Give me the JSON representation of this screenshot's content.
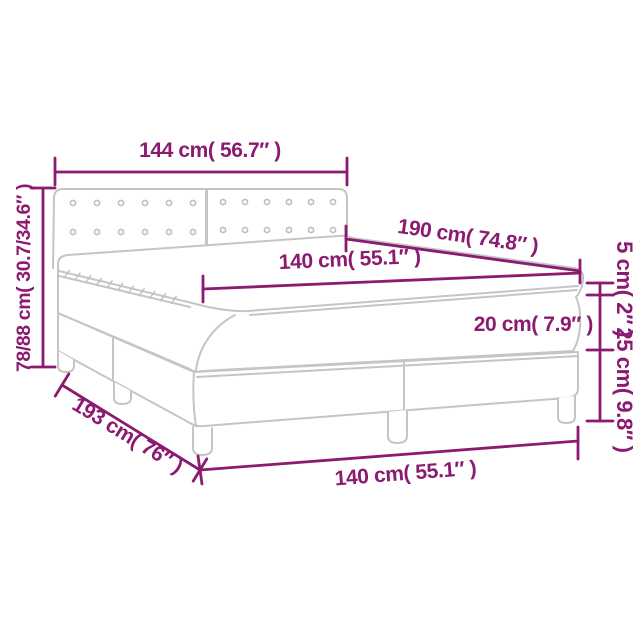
{
  "figure": {
    "kind": "product-dimension-diagram",
    "subject": "box-spring bed with tufted headboard, mattress and topper",
    "background_color": "#ffffff",
    "accent_color": "#8c1a70",
    "drawing_line_color": "#c5c5c5",
    "dimensions": {
      "headboard_width": "144 cm( 56.7″ )",
      "total_height": "78/88 cm( 30.7/34.6″ )",
      "bed_length": "190 cm( 74.8″ )",
      "mattress_width_top": "140 cm( 55.1″ )",
      "topper_thickness": "5 cm( 2″ )",
      "mattress_thickness": "20 cm( 7.9″ )",
      "base_height": "25 cm( 9.8″ )",
      "base_length": "193 cm( 76″ )",
      "mattress_width_bottom": "140 cm( 55.1″ )"
    }
  }
}
